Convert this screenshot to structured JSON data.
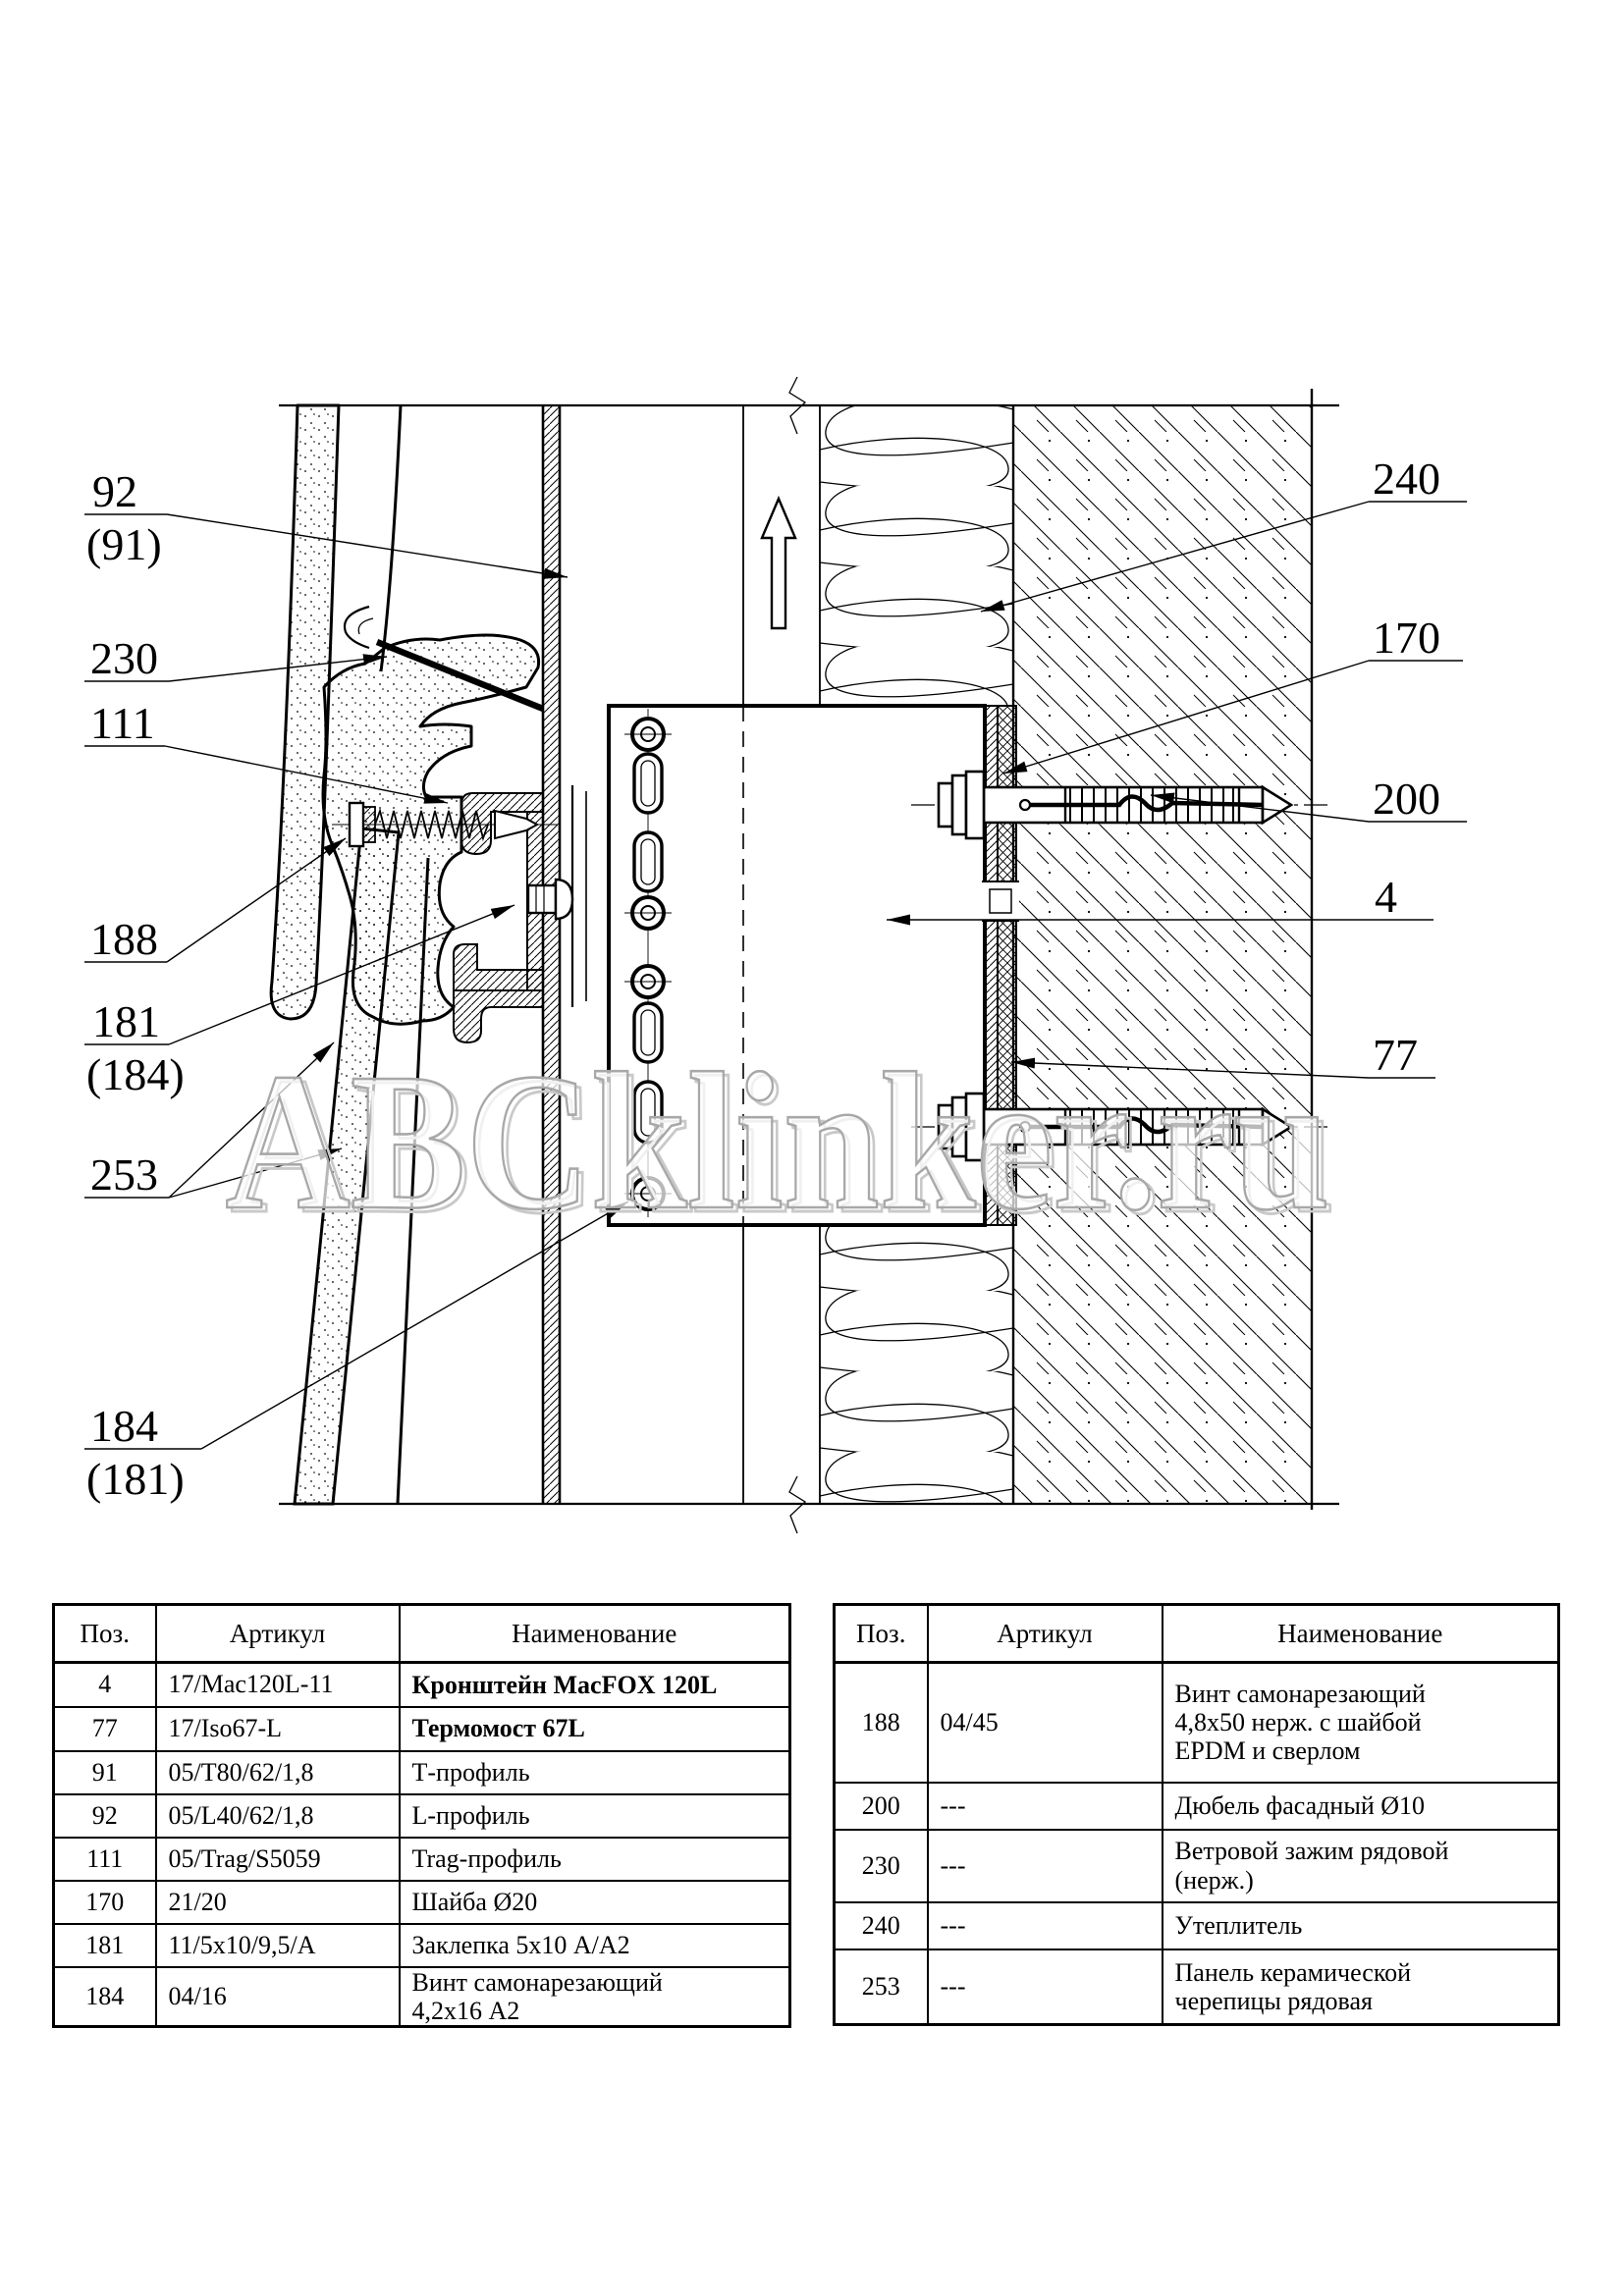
{
  "watermark": "ABCklinker.ru",
  "colors": {
    "line": "#000000",
    "watermark_stroke": "#a8a8a8",
    "background": "#ffffff"
  },
  "icons": {
    "up_arrow": "up-direction-arrow",
    "leader_arrow": "filled-triangle-arrowhead"
  },
  "drawing": {
    "left_callouts": [
      {
        "id": "92",
        "line1": "92",
        "line2": "(91)"
      },
      {
        "id": "230",
        "line1": "230"
      },
      {
        "id": "111",
        "line1": "111"
      },
      {
        "id": "188",
        "line1": "188"
      },
      {
        "id": "181",
        "line1": "181",
        "line2": "(184)"
      },
      {
        "id": "253",
        "line1": "253"
      },
      {
        "id": "184",
        "line1": "184",
        "line2": "(181)"
      }
    ],
    "right_callouts": [
      {
        "id": "240",
        "line1": "240"
      },
      {
        "id": "170",
        "line1": "170"
      },
      {
        "id": "200",
        "line1": "200"
      },
      {
        "id": "4",
        "line1": "4"
      },
      {
        "id": "77",
        "line1": "77"
      }
    ]
  },
  "tables": {
    "left": {
      "headers": [
        "Поз.",
        "Артикул",
        "Наименование"
      ],
      "rows": [
        {
          "pos": "4",
          "art": "17/Mac120L-11",
          "name": "Кронштейн MacFOX 120L"
        },
        {
          "pos": "77",
          "art": "17/Iso67-L",
          "name": "Термомост 67L"
        },
        {
          "pos": "91",
          "art": "05/T80/62/1,8",
          "name": "Т-профиль"
        },
        {
          "pos": "92",
          "art": "05/L40/62/1,8",
          "name": "L-профиль"
        },
        {
          "pos": "111",
          "art": "05/Trag/S5059",
          "name": "Trag-профиль"
        },
        {
          "pos": "170",
          "art": "21/20",
          "name": "Шайба Ø20"
        },
        {
          "pos": "181",
          "art": "11/5x10/9,5/A",
          "name": "Заклепка 5x10 А/А2"
        },
        {
          "pos": "184",
          "art": "04/16",
          "name": "Винт самонарезающий\n4,2x16 А2"
        }
      ]
    },
    "right": {
      "headers": [
        "Поз.",
        "Артикул",
        "Наименование"
      ],
      "rows": [
        {
          "pos": "188",
          "art": "04/45",
          "name": "Винт самонарезающий\n4,8x50 нерж. с шайбой\nEPDM и сверлом"
        },
        {
          "pos": "200",
          "art": "---",
          "name": "Дюбель фасадный Ø10"
        },
        {
          "pos": "230",
          "art": "---",
          "name": "Ветровой зажим рядовой\n(нерж.)"
        },
        {
          "pos": "240",
          "art": "---",
          "name": "Утеплитель"
        },
        {
          "pos": "253",
          "art": "---",
          "name": "Панель керамической\nчерепицы рядовая"
        }
      ]
    }
  }
}
